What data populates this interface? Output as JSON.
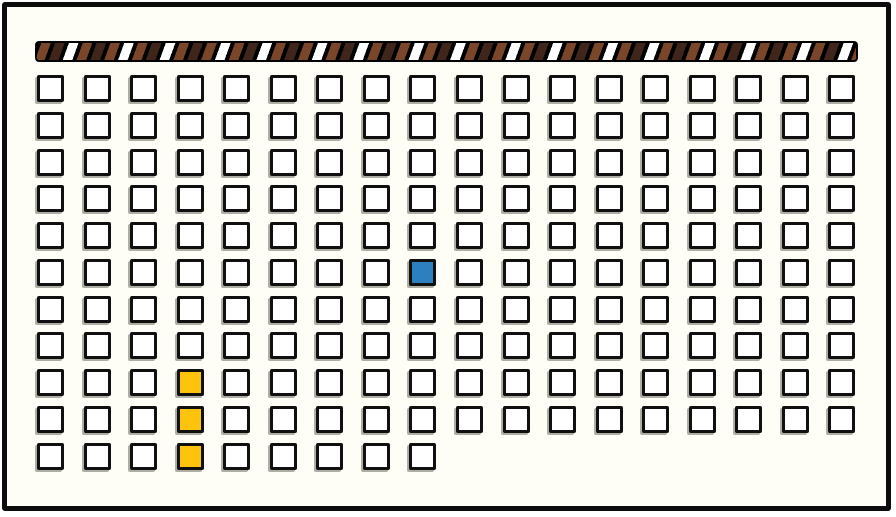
{
  "board": {
    "background_color": "#fffef6",
    "border_color": "#0c0c0c"
  },
  "striped_bar": {
    "description": "hatched horizontal bar",
    "stripe_colors": {
      "background": "#000000",
      "brown": "#7a4629",
      "dark_brown": "#40261a",
      "white": "#ffffff"
    }
  },
  "grid": {
    "columns": 18,
    "rows": 11,
    "last_row_cells": 9,
    "total_cells": 189,
    "cell_default_color": "#ffffff",
    "cell_border_color": "#101010",
    "highlight_colors": {
      "blue": "#2d80c0",
      "yellow": "#fec30d"
    },
    "highlighted_cells": [
      {
        "row": 6,
        "col": 9,
        "color": "#2d80c0",
        "label": "blue-cell"
      },
      {
        "row": 9,
        "col": 4,
        "color": "#fec30d",
        "label": "yellow-cell"
      },
      {
        "row": 10,
        "col": 4,
        "color": "#fec30d",
        "label": "yellow-cell"
      },
      {
        "row": 11,
        "col": 4,
        "color": "#fec30d",
        "label": "yellow-cell"
      }
    ]
  }
}
